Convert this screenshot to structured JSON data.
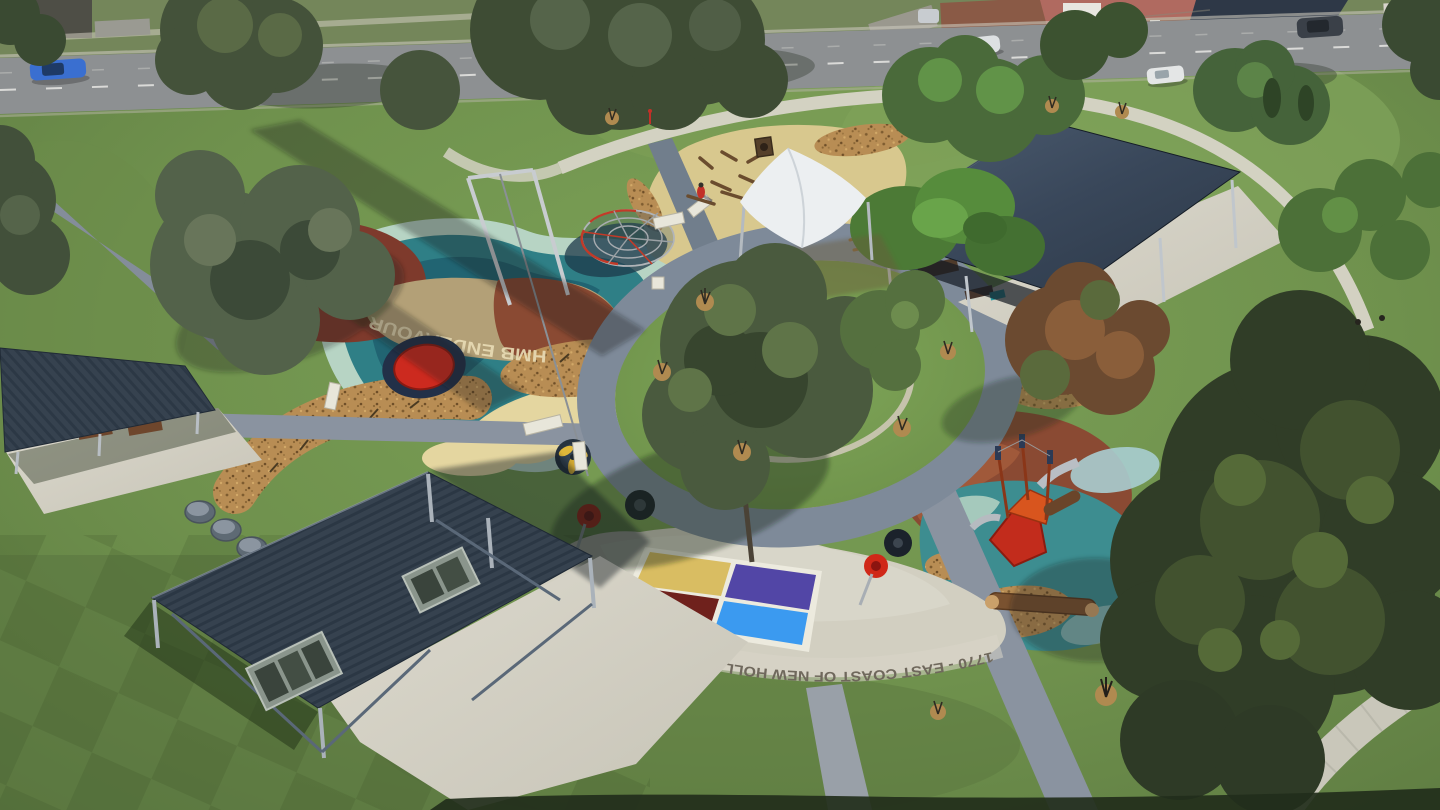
{
  "scene": {
    "type": "aerial-drone-photo",
    "description": "Aerial view of a circular commemorative playground precinct in a suburban park, road and houses along the top, picnic shelters, shade sail, softfall play areas around a central tree ring"
  },
  "ground_text": {
    "apron_arc": "1770 - EAST COAST OF NEW HOLLAND",
    "softfall_vessel": "HMB ENDEAVOUR",
    "orientation": "rotated-180-degrees"
  },
  "painted_squares": {
    "order": [
      "gold",
      "indigo",
      "maroon",
      "blue"
    ],
    "outline": "white"
  },
  "road": {
    "marking": "dashed-white-centerline",
    "cars": [
      {
        "color": "blue"
      },
      {
        "color": "silver"
      },
      {
        "color": "white-van"
      },
      {
        "color": "white"
      },
      {
        "color": "dark-grey"
      }
    ]
  },
  "features": {
    "shelters": [
      "west-picnic-shelter",
      "large-southwest-picnic-shelter",
      "northeast-picnic-shelter"
    ],
    "play_equipment": [
      "rope-climbing-dome",
      "flying-fox-frame",
      "shade-sail-sandpit",
      "timber-obstacle-course",
      "ship-play-unit",
      "spinner-seat",
      "spinner-seat",
      "carousel-spinner",
      "balance-log",
      "red-play-disc"
    ],
    "bins": 3,
    "central_feature": "ring-path-around-large-tree"
  },
  "palette": {
    "grass-base": "#6f914d",
    "grass-bright": "#7ca257",
    "grass-dark": "#5d7a41",
    "road": "#8d9092",
    "path-concrete": "#d8d5c8",
    "path-asphalt": "#8a93a0",
    "ring": "#7e8a99",
    "roof-slate": "#36424f",
    "steel": "#c0c6cc",
    "softfall-teal": "#2f7f86",
    "softfall-teal-deep": "#1f5f6e",
    "softfall-mint": "#b7d4c4",
    "softfall-sand": "#e4d6a0",
    "softfall-tan": "#d8c88e",
    "softfall-khaki": "#b3a077",
    "softfall-maroon": "#7e3a2c",
    "softfall-brown": "#8a4a33",
    "softfall-rust": "#a0593a",
    "mulch": "#b88d54",
    "sail": "#eceff1",
    "equip-red": "#cf2b20",
    "sq-gold": "#d9bd62",
    "sq-indigo": "#5246a6",
    "sq-maroon": "#6f211c",
    "sq-blue": "#3b9af0",
    "tree-dark": "#3f4f33",
    "tree-mid": "#55703f",
    "house-roof": "#b06a60"
  }
}
